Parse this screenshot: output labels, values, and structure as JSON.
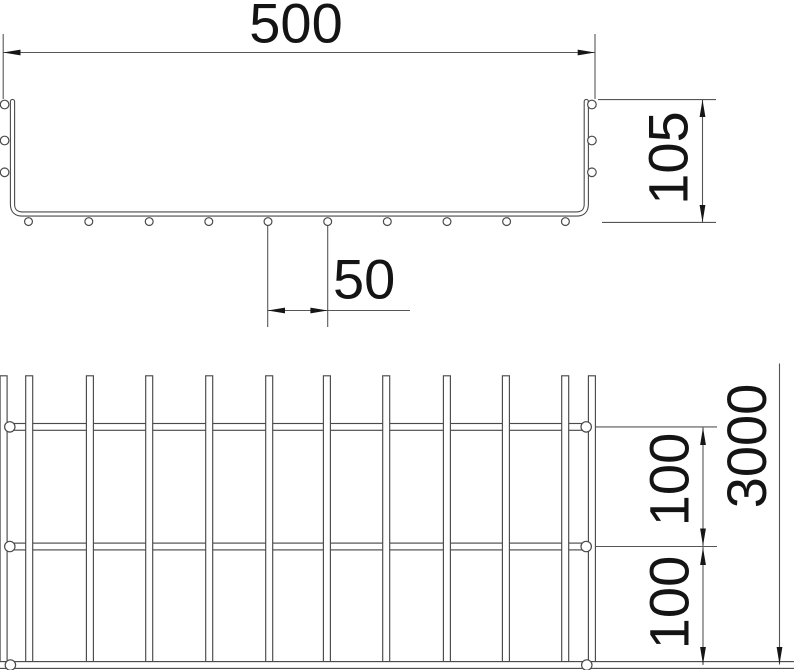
{
  "cross_section": {
    "width_label": "500",
    "height_label": "105",
    "spacing_label": "50"
  },
  "plan": {
    "length_label": "3000",
    "pitch_upper_label": "100",
    "pitch_lower_label": "100"
  },
  "colors": {
    "geometry_line": "#4a4a4a",
    "dimension_line": "#565656",
    "text": "#141414",
    "background": "#ffffff"
  }
}
